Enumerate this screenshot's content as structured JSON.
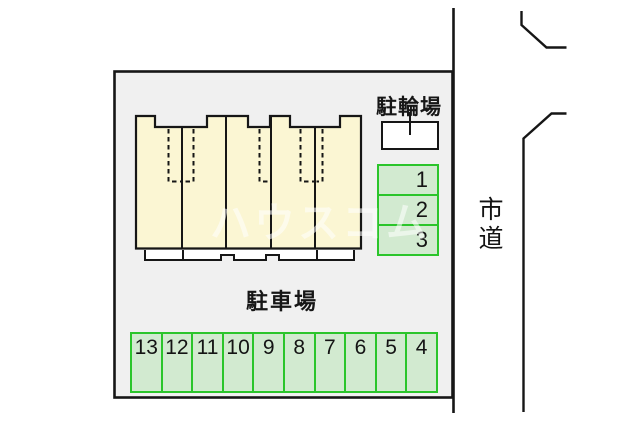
{
  "plan": {
    "bicycle_parking": {
      "label": "駐輪場"
    },
    "parking_lot": {
      "label": "駐車場",
      "side_spaces": [
        {
          "label": "1"
        },
        {
          "label": "2"
        },
        {
          "label": "3"
        }
      ],
      "bottom_spaces": [
        {
          "label": "13"
        },
        {
          "label": "12"
        },
        {
          "label": "11"
        },
        {
          "label": "10"
        },
        {
          "label": "9"
        },
        {
          "label": "8"
        },
        {
          "label": "7"
        },
        {
          "label": "6"
        },
        {
          "label": "5"
        },
        {
          "label": "4"
        }
      ]
    },
    "road": {
      "label": "市道"
    },
    "watermark": "ハウスコム"
  },
  "colors": {
    "site_fill": "#f0f0f0",
    "line": "#161616",
    "building_fill": "#fbf6d3",
    "porch_fill": "#ffffff",
    "space_border": "#2bc52b",
    "space_fill": "#d2ead0"
  }
}
